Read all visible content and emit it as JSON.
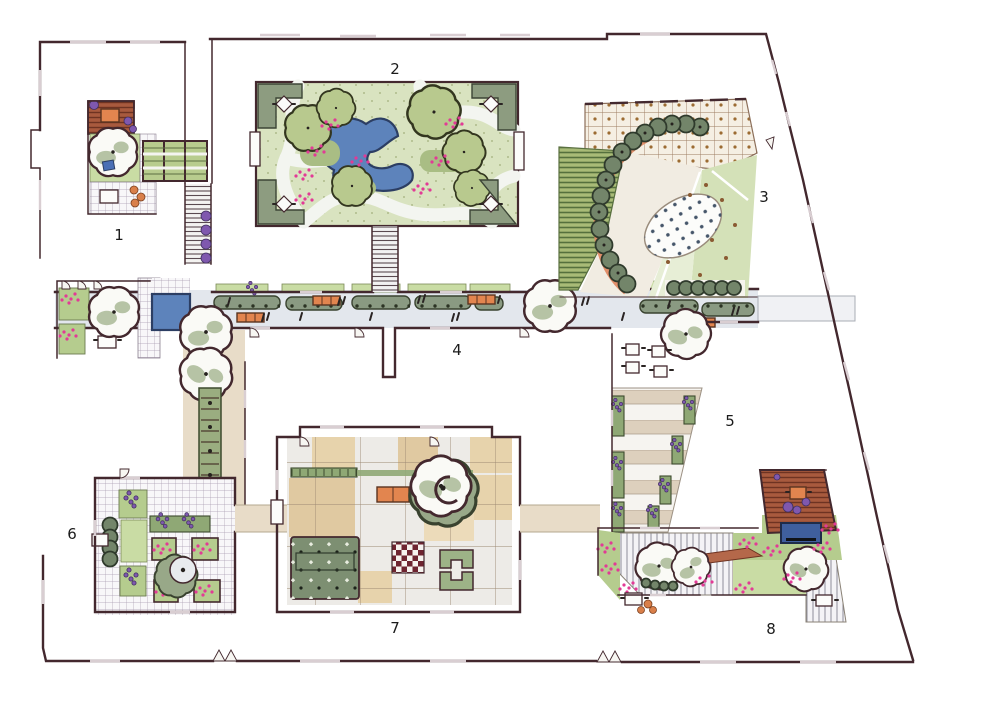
{
  "areas": [
    {
      "label": "1"
    },
    {
      "label": "2"
    },
    {
      "label": "3"
    },
    {
      "label": "4"
    },
    {
      "label": "5"
    },
    {
      "label": "6"
    },
    {
      "label": "7"
    },
    {
      "label": "8"
    }
  ],
  "palette": {
    "wall": "#43282e",
    "paving": "#e3e7ed",
    "tan": "#e8dcc8",
    "lawn": "#d9e3c0",
    "bed": "#b5cc8e",
    "water": "#5d83bb",
    "waterDark": "#3f5f9e",
    "bench": "#e2854f",
    "salmon": "#e08a64",
    "deck": "#a85a3e",
    "purple": "#7f58ae",
    "pink": "#e23a96",
    "checker": "#6e2430",
    "label": "#1b1b1b"
  }
}
